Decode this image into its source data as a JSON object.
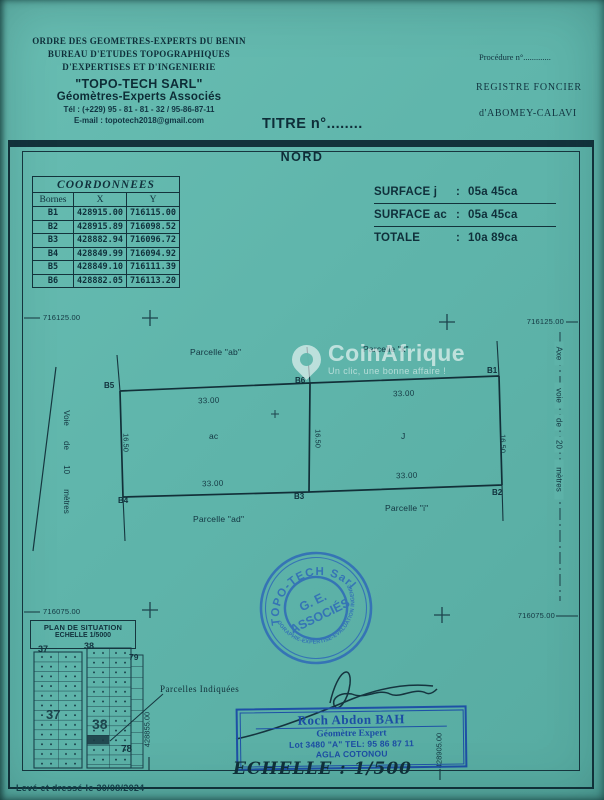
{
  "letterhead": {
    "org_line1": "ORDRE DES GEOMETRES-EXPERTS DU BENIN",
    "org_line2": "BUREAU D'ETUDES TOPOGRAPHIQUES",
    "org_line3": "D'EXPERTISES ET D'INGENIERIE",
    "company": "\"TOPO-TECH SARL\"",
    "subtitle": "Géomètres-Experts Associés",
    "phone": "Tél : (+229) 95 - 81 - 81 - 32 / 95-86-87-11",
    "email": "E-mail : topotech2018@gmail.com"
  },
  "registry": {
    "procedure": "Procédure n°.............",
    "register": "REGISTRE FONCIER",
    "location": "d'ABOMEY-CALAVI",
    "title_no": "TITRE n°........"
  },
  "plan": {
    "north": "NORD",
    "table": {
      "title": "COORDONNEES",
      "columns": [
        "Bornes",
        "X",
        "Y"
      ],
      "rows": [
        [
          "B1",
          "428915.00",
          "716115.00"
        ],
        [
          "B2",
          "428915.89",
          "716098.52"
        ],
        [
          "B3",
          "428882.94",
          "716096.72"
        ],
        [
          "B4",
          "428849.99",
          "716094.92"
        ],
        [
          "B5",
          "428849.10",
          "716111.39"
        ],
        [
          "B6",
          "428882.05",
          "716113.20"
        ]
      ]
    },
    "surfaces": [
      {
        "label": "SURFACE j",
        "value": "05a 45ca"
      },
      {
        "label": "SURFACE ac",
        "value": "05a 45ca"
      },
      {
        "label": "TOTALE",
        "value": "10a 89ca"
      }
    ],
    "grid": {
      "y_top": "716125.00",
      "y_bottom": "716075.00",
      "x_left": "428855.00",
      "x_right": "428905.00"
    },
    "west_road": "Voie de 10 mètres",
    "east_axis": [
      "Axe",
      "voie",
      "de",
      "20",
      "mètres"
    ],
    "bornes": [
      "B1",
      "B2",
      "B3",
      "B4",
      "B5",
      "B6"
    ],
    "dims": {
      "top": [
        "33.00",
        "33.00"
      ],
      "bottom": [
        "33.00",
        "33.00"
      ],
      "side": [
        "16.50",
        "16.50",
        "16.50"
      ]
    },
    "parcel_labels": {
      "top_left": "Parcelle \"ab\"",
      "top_right": "Parcelle \"k\"",
      "bottom_left": "Parcelle \"ad\"",
      "bottom_right": "Parcelle \"i\"",
      "cell_left": "ac",
      "cell_right": "J"
    }
  },
  "situation": {
    "title_line1": "PLAN DE SITUATION",
    "title_line2": "ECHELLE 1/5000",
    "blocks": [
      "37",
      "38",
      "79",
      "37",
      "38",
      "78"
    ],
    "note": "Parcelles Indiquées"
  },
  "stamp": {
    "arc_top": "TOPO-TECH Sarl",
    "arc_bottom": "TOPOGRAPHIE-EXPERTISE-EVALUATION INGENIERIE",
    "center_line1": "G. E.",
    "center_line2": "ASSOCIÉS"
  },
  "surveyor": {
    "name": "Roch Abdon BAH",
    "role": "Géomètre Expert",
    "address": "Lot 3480 \"A\" TEL: 95 86 87 11",
    "city": "AGLA COTONOU"
  },
  "scale": "ECHELLE : 1/500",
  "footer": "Levé et dressé le 30/08/2024",
  "watermark": {
    "brand": "CoinAfrique",
    "tagline": "Un clic, une bonne affaire !"
  },
  "colors": {
    "paper_teal": "#5fb5ab",
    "ink_dark": "#13323b",
    "stamp_blue": "#2f6ab8",
    "box_blue": "#1e50a6",
    "watermark_white": "rgba(255,255,255,0.6)"
  }
}
